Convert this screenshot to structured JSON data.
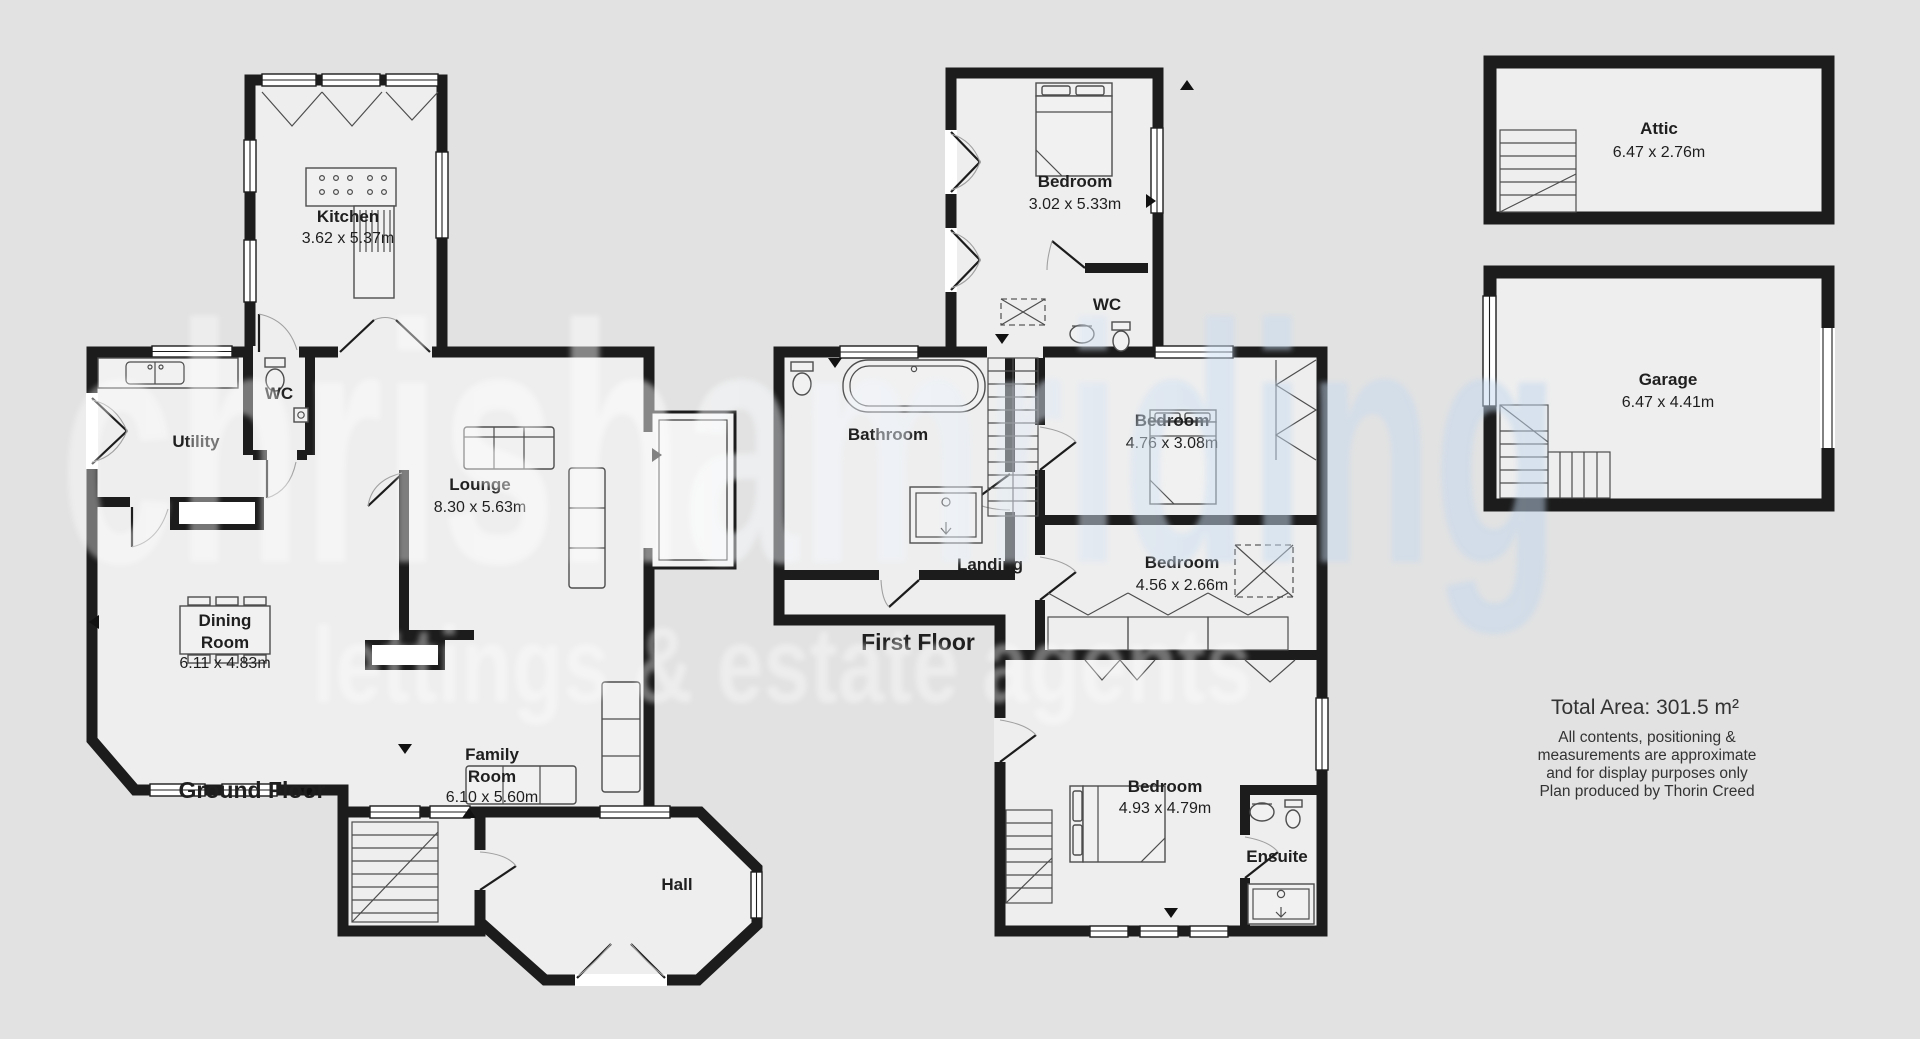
{
  "watermark": {
    "line1": "chrishamriding",
    "line2": "lettings & estate agents"
  },
  "floors": {
    "ground": {
      "label": "Ground Floor",
      "kitchen_name": "Kitchen",
      "kitchen_dims": "3.62 x 5.37m",
      "wc": "WC",
      "utility": "Utility",
      "lounge_name": "Lounge",
      "lounge_dims": "8.30 x 5.63m",
      "dining_l1": "Dining",
      "dining_l2": "Room",
      "dining_dims": "6.11 x 4.83m",
      "family_l1": "Family",
      "family_l2": "Room",
      "family_dims": "6.10 x 5.60m",
      "hall": "Hall"
    },
    "first": {
      "label": "First Floor",
      "bed_top_name": "Bedroom",
      "bed_top_dims": "3.02 x 5.33m",
      "wc": "WC",
      "bathroom": "Bathroom",
      "bed_mid_name": "Bedroom",
      "bed_mid_dims": "4.76 x 3.08m",
      "landing": "Landing",
      "bed_small_name": "Bedroom",
      "bed_small_dims": "4.56 x 2.66m",
      "bed_master_name": "Bedroom",
      "bed_master_dims": "4.93 x 4.79m",
      "ensuite": "Ensuite"
    },
    "attic": {
      "name": "Attic",
      "dims": "6.47 x 2.76m"
    },
    "garage": {
      "name": "Garage",
      "dims": "6.47 x 4.41m"
    }
  },
  "summary": {
    "total_area": "Total Area: 301.5 m²",
    "disclaimer": [
      "All contents, positioning &",
      "measurements are approximate",
      "and for display purposes only",
      "Plan produced by Thorin Creed"
    ]
  },
  "colors": {
    "background": "#e2e2e2",
    "room_fill": "#eeeeee",
    "wall": "#1c1c1c",
    "label_text": "#1f1f1f",
    "watermark_white": "#ffffff",
    "watermark_blue": "#c0d6ee"
  }
}
